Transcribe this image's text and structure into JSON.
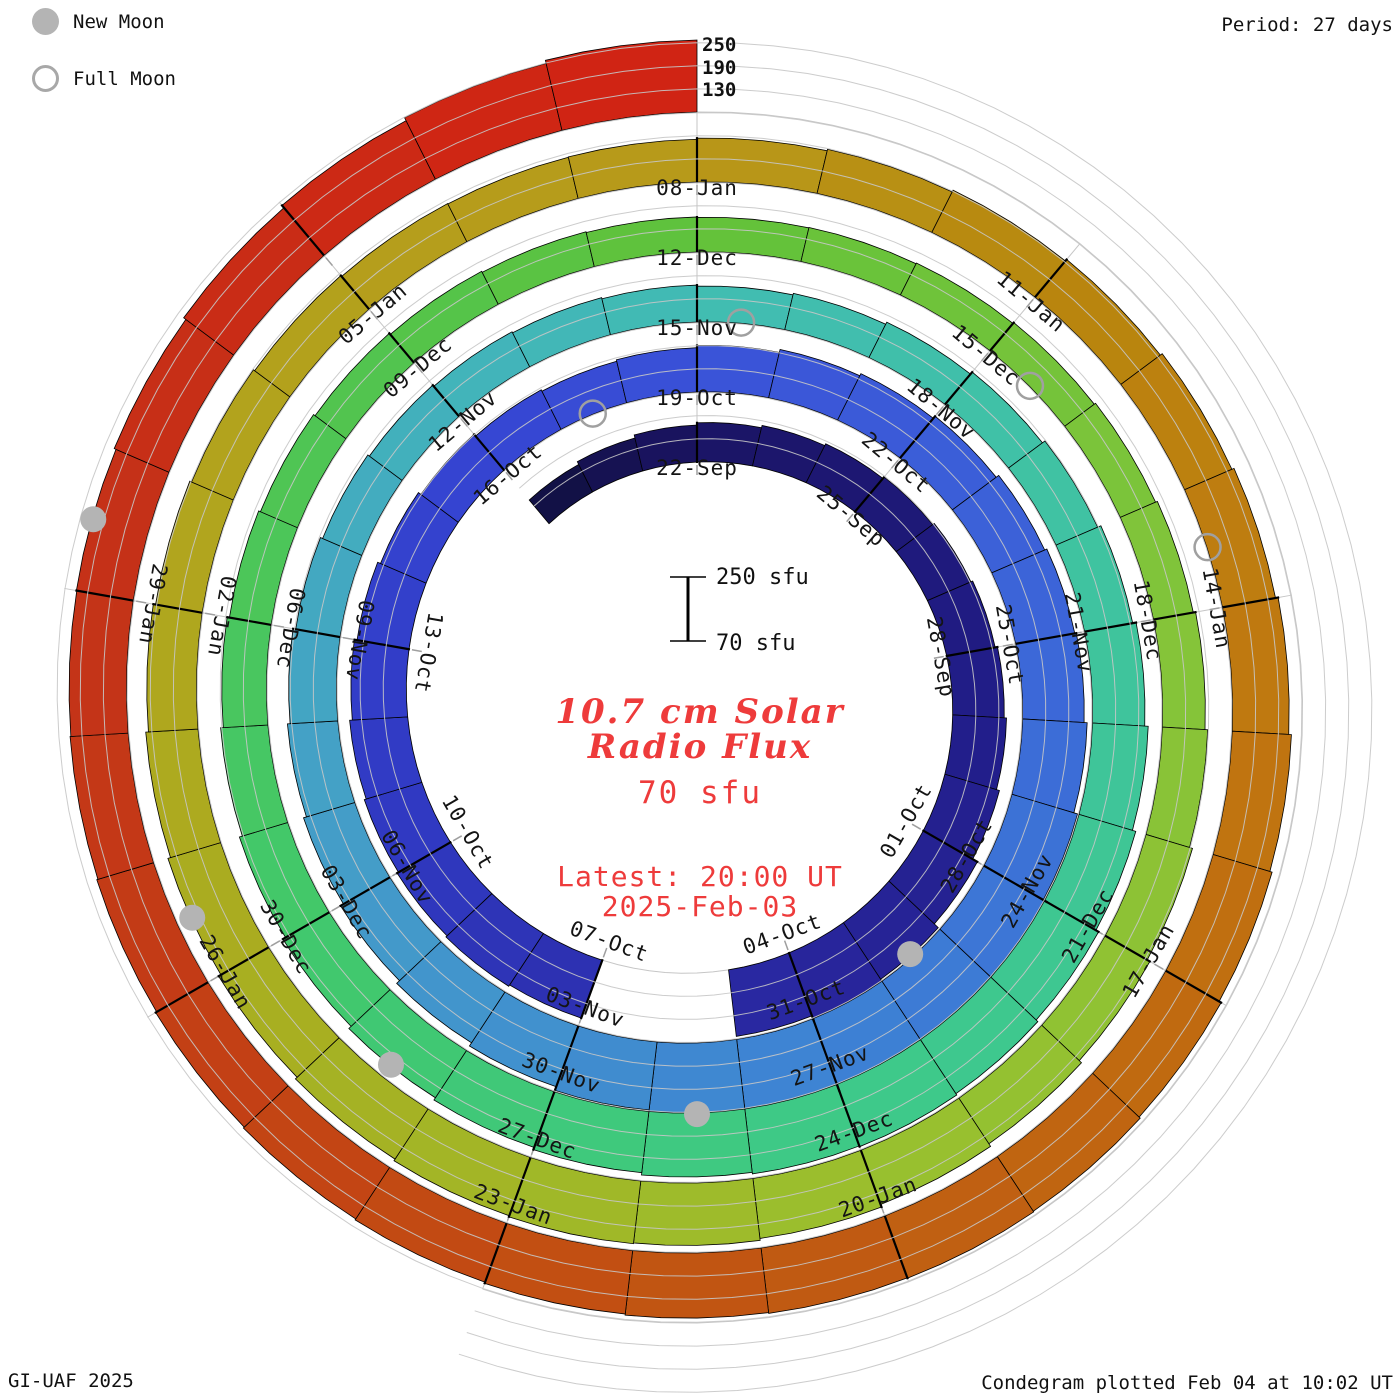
{
  "header": {
    "period_label": "Period: 27 days"
  },
  "legend": {
    "new_moon_label": "New Moon",
    "full_moon_label": "Full Moon"
  },
  "footer": {
    "credit": "GI-UAF 2025",
    "plotted": "Condegram plotted Feb 04 at 10:02 UT"
  },
  "center": {
    "title_line1": "10.7 cm Solar",
    "title_line2": "Radio Flux",
    "unit_value": "70 sfu",
    "latest_line1": "Latest: 20:00 UT",
    "latest_line2": "2025-Feb-03",
    "scalebar": {
      "top_label": "250 sfu",
      "bottom_label": "70 sfu"
    }
  },
  "radial_scale_labels": [
    "250",
    "190",
    "130"
  ],
  "colors": {
    "background": "#ffffff",
    "accent_red_text": "#ee3b3b",
    "grid_gray": "#c6c6c6",
    "moon_gray": "#b4b4b4",
    "label_black": "#141414"
  },
  "chart_data": {
    "type": "spiral-condegram",
    "title": "10.7 cm Solar Radio Flux",
    "period_days": 27,
    "start_date": "2024-09-19",
    "end_date": "2025-02-03",
    "flux_baseline_sfu": 70,
    "flux_gridlines_sfu": [
      130,
      190,
      250
    ],
    "direction": "clockwise, one turn per 27 days, time increasing outward",
    "days_flux_sfu": [
      150,
      158,
      166,
      172,
      178,
      183,
      188,
      193,
      198,
      204,
      210,
      218,
      232,
      246,
      256,
      244,
      null,
      null,
      230,
      234,
      230,
      226,
      221,
      214,
      207,
      199,
      191,
      185,
      181,
      185,
      191,
      199,
      205,
      212,
      220,
      226,
      230,
      238,
      248,
      258,
      266,
      270,
      268,
      258,
      248,
      238,
      228,
      218,
      209,
      201,
      194,
      187,
      181,
      176,
      172,
      169,
      166,
      163,
      167,
      173,
      180,
      188,
      197,
      206,
      215,
      224,
      232,
      238,
      242,
      240,
      236,
      230,
      224,
      217,
      209,
      201,
      193,
      186,
      180,
      175,
      170,
      166,
      163,
      161,
      160,
      161,
      163,
      166,
      170,
      175,
      181,
      188,
      196,
      204,
      212,
      220,
      227,
      232,
      234,
      231,
      226,
      220,
      213,
      206,
      199,
      193,
      188,
      184,
      181,
      180,
      181,
      184,
      188,
      193,
      198,
      204,
      210,
      217,
      224,
      230,
      236,
      240,
      242,
      241,
      239,
      236,
      233,
      230,
      227,
      224,
      221,
      219,
      220,
      225,
      232,
      240,
      249,
      257
    ],
    "date_labels": [
      {
        "label": "22-Sep",
        "day": 3
      },
      {
        "label": "25-Sep",
        "day": 6
      },
      {
        "label": "28-Sep",
        "day": 9
      },
      {
        "label": "01-Oct",
        "day": 12
      },
      {
        "label": "04-Oct",
        "day": 15
      },
      {
        "label": "07-Oct",
        "day": 18
      },
      {
        "label": "10-Oct",
        "day": 21
      },
      {
        "label": "13-Oct",
        "day": 24
      },
      {
        "label": "16-Oct",
        "day": 27
      },
      {
        "label": "19-Oct",
        "day": 30
      },
      {
        "label": "22-Oct",
        "day": 33
      },
      {
        "label": "25-Oct",
        "day": 36
      },
      {
        "label": "28-Oct",
        "day": 39
      },
      {
        "label": "31-Oct",
        "day": 42
      },
      {
        "label": "03-Nov",
        "day": 45
      },
      {
        "label": "06-Nov",
        "day": 48
      },
      {
        "label": "09-Nov",
        "day": 51
      },
      {
        "label": "12-Nov",
        "day": 54
      },
      {
        "label": "15-Nov",
        "day": 57
      },
      {
        "label": "18-Nov",
        "day": 60
      },
      {
        "label": "21-Nov",
        "day": 63
      },
      {
        "label": "24-Nov",
        "day": 66
      },
      {
        "label": "27-Nov",
        "day": 69
      },
      {
        "label": "30-Nov",
        "day": 72
      },
      {
        "label": "03-Dec",
        "day": 75
      },
      {
        "label": "06-Dec",
        "day": 78
      },
      {
        "label": "09-Dec",
        "day": 81
      },
      {
        "label": "12-Dec",
        "day": 84
      },
      {
        "label": "15-Dec",
        "day": 87
      },
      {
        "label": "18-Dec",
        "day": 90
      },
      {
        "label": "21-Dec",
        "day": 93
      },
      {
        "label": "24-Dec",
        "day": 96
      },
      {
        "label": "27-Dec",
        "day": 99
      },
      {
        "label": "30-Dec",
        "day": 102
      },
      {
        "label": "02-Jan",
        "day": 105
      },
      {
        "label": "05-Jan",
        "day": 108
      },
      {
        "label": "08-Jan",
        "day": 111
      },
      {
        "label": "11-Jan",
        "day": 114
      },
      {
        "label": "14-Jan",
        "day": 117
      },
      {
        "label": "17-Jan",
        "day": 120
      },
      {
        "label": "20-Jan",
        "day": 123
      },
      {
        "label": "23-Jan",
        "day": 126
      },
      {
        "label": "26-Jan",
        "day": 129
      },
      {
        "label": "29-Jan",
        "day": 132
      }
    ],
    "new_moons": [
      {
        "date": "02-Oct",
        "day": 13
      },
      {
        "date": "01-Nov",
        "day": 43
      },
      {
        "date": "01-Dec",
        "day": 73
      },
      {
        "date": "30-Dec",
        "day": 102
      },
      {
        "date": "29-Jan",
        "day": 132
      }
    ],
    "full_moons": [
      {
        "date": "17-Oct",
        "day": 28
      },
      {
        "date": "15-Nov",
        "day": 57
      },
      {
        "date": "15-Dec",
        "day": 87
      },
      {
        "date": "13-Jan",
        "day": 116
      }
    ],
    "color_stops": [
      [
        0,
        "#101040"
      ],
      [
        3,
        "#1b1464"
      ],
      [
        9,
        "#201c85"
      ],
      [
        14,
        "#272498"
      ],
      [
        21,
        "#3038c0"
      ],
      [
        27,
        "#3545d2"
      ],
      [
        30,
        "#3a52d8"
      ],
      [
        36,
        "#3c66d8"
      ],
      [
        42,
        "#3d82d4"
      ],
      [
        48,
        "#449bc9"
      ],
      [
        54,
        "#42b2bb"
      ],
      [
        57,
        "#41bcb3"
      ],
      [
        63,
        "#3fc49e"
      ],
      [
        69,
        "#3ec988"
      ],
      [
        75,
        "#41c86c"
      ],
      [
        81,
        "#53c44c"
      ],
      [
        84,
        "#61c23a"
      ],
      [
        90,
        "#83c43a"
      ],
      [
        96,
        "#9ac02e"
      ],
      [
        102,
        "#a9ad20"
      ],
      [
        105,
        "#b0a61e"
      ],
      [
        111,
        "#b8991a"
      ],
      [
        114,
        "#b8870e"
      ],
      [
        117,
        "#bf7b10"
      ],
      [
        120,
        "#c06c10"
      ],
      [
        123,
        "#c05d12"
      ],
      [
        126,
        "#c24c12"
      ],
      [
        129,
        "#c33d16"
      ],
      [
        132,
        "#c43218"
      ],
      [
        135,
        "#ca2b15"
      ],
      [
        137,
        "#d02414"
      ]
    ]
  }
}
